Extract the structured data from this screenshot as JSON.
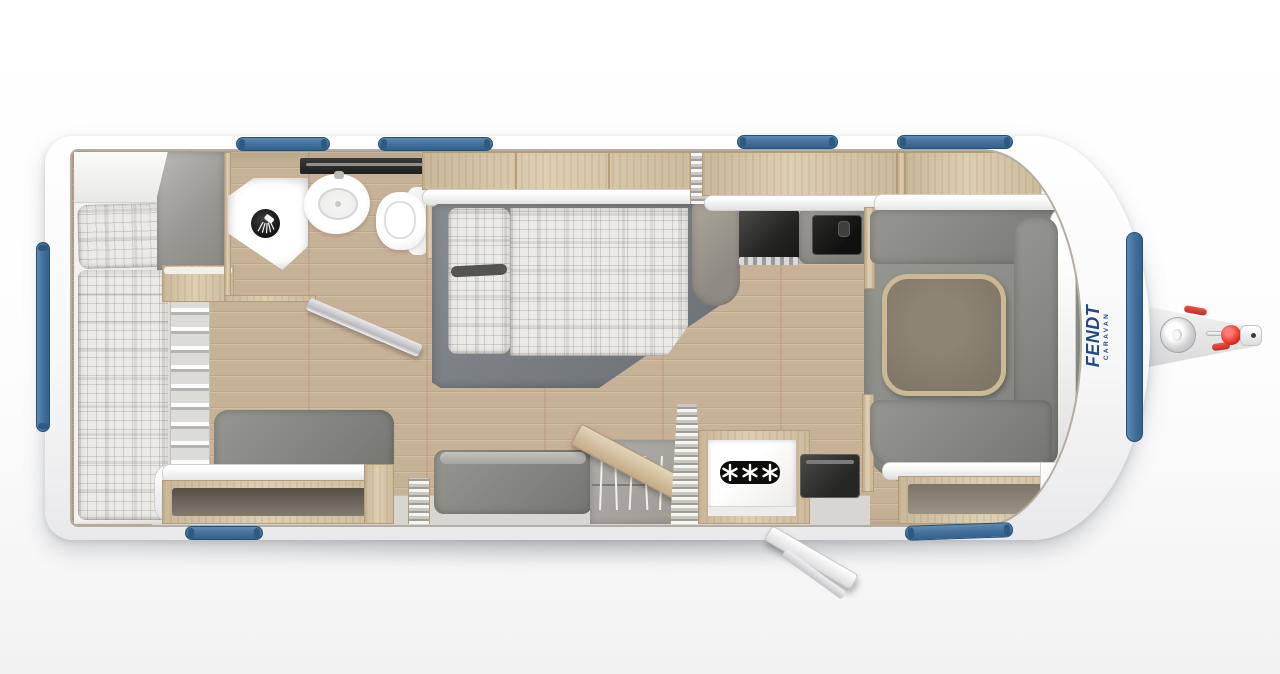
{
  "page": {
    "title": "Fendt caravan floor plan — top view",
    "background": "#ffffff"
  },
  "logo": {
    "brand": "FENDT",
    "subtitle": "CARAVAN",
    "color": "#24497f"
  },
  "appliances": {
    "fridge_rating": "✳✳✳"
  },
  "palette": {
    "window_blue": "#4a78a3",
    "window_blue_dark": "#2e5a82",
    "body_white": "#fbfbfb",
    "floor_wood": "#c7b197",
    "furniture_wood": "#d9c6a6",
    "upholstery_gray": "#8b8d85",
    "bed_platform_gray": "#7c8186",
    "carpet_gray": "#8f9089",
    "table_top": "#857b6b",
    "table_edge": "#c9b994",
    "plaid_fabric": "#eceae6",
    "appliance_dark": "#2a2a28",
    "hitch_red": "#d63a34"
  },
  "features": [
    "single-bed-rear",
    "bunk-ladder",
    "rear-wardrobe",
    "corner-shower",
    "shower-icon",
    "washbasin",
    "toilet",
    "bathroom-mirror-door-open",
    "french-bed",
    "overhead-lockers",
    "concertina-door",
    "kitchen-sink-unit",
    "gas-hob",
    "fridge-freezer",
    "snowflake-rating-icon",
    "wardrobe-hanging-rail",
    "clothes-hangers",
    "sofa-bench",
    "upholstered-chest",
    "entry-door-open",
    "u-shape-dinette",
    "dinette-table",
    "carpet",
    "side-windows",
    "front-window",
    "rear-window",
    "drawbar",
    "jockey-wheel",
    "hitch-coupling"
  ]
}
